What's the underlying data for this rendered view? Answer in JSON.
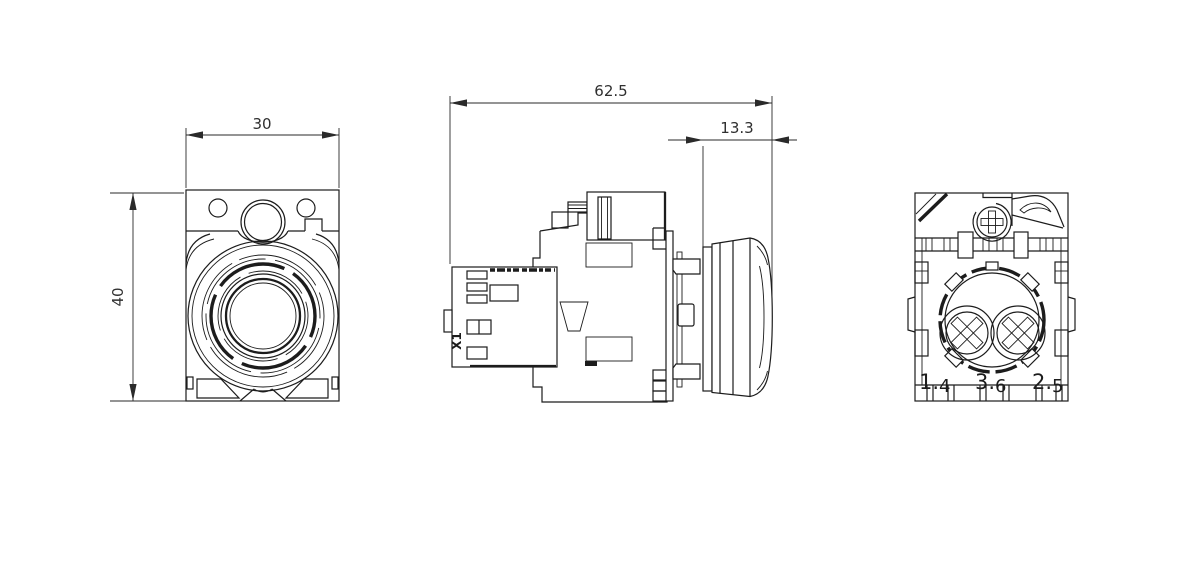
{
  "drawing": {
    "background": "#ffffff",
    "line_color": "#1c1c1c",
    "dimensions": {
      "front_width": "30",
      "front_height": "40",
      "side_total_depth": "62.5",
      "side_front_projection": "13.3"
    },
    "labels": {
      "side_connector": "X1",
      "rear_terminals": [
        {
          "main": "1.",
          "sub": "4"
        },
        {
          "main": "3.",
          "sub": "6"
        },
        {
          "main": "2.",
          "sub": "5"
        }
      ]
    }
  }
}
